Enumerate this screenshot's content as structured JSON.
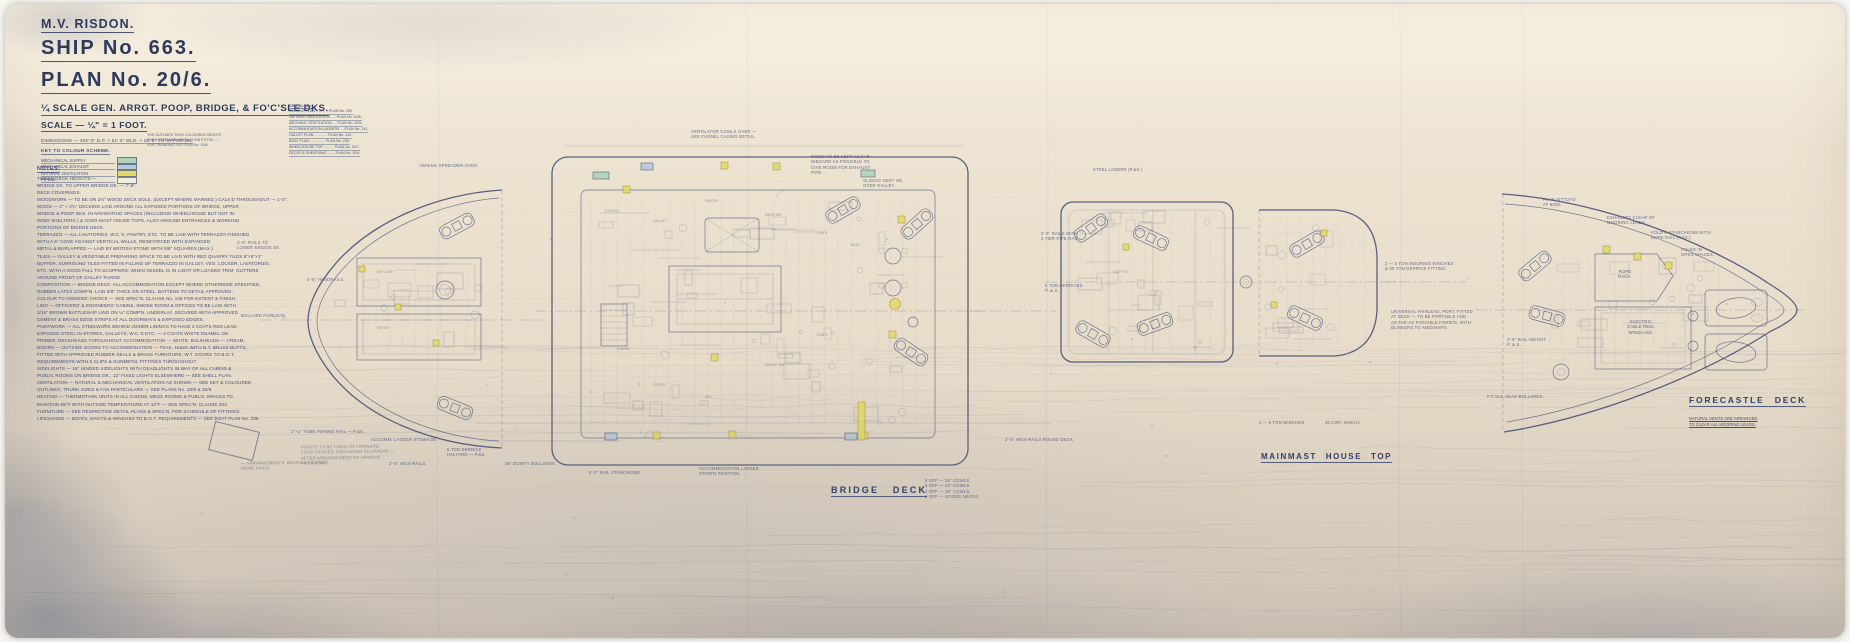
{
  "meta": {
    "paper_color": "#ebe1cf",
    "ink_color": "#3d4b75",
    "ink_strong": "#2e3a5c",
    "pencil_color": "#686d84",
    "vent_yellow": "#e2d86a"
  },
  "title_block": {
    "vessel": "M.V. RISDON.",
    "ship_no": "SHIP No. 663.",
    "plan_no": "PLAN No. 20/6.",
    "subtitle": "¼ SCALE GEN. ARRGT. POOP, BRIDGE, & FO'C'SLE DKS.",
    "scale": "SCALE — ¼\" = 1 FOOT.",
    "dimensions": "DIMENSIONS — 355'-0\" B.P. × 51'-6\" MLD. × 26'-6\" TO UPPER DK.",
    "key_heading": "KEY TO COLOUR SCHEME.",
    "key_items": [
      {
        "label": "MECHANICAL SUPPLY",
        "color": "#b2d0ba"
      },
      {
        "label": "MECHANICAL EXHAUST",
        "color": "#bcc9d7"
      },
      {
        "label": "NATURAL VENTILATION",
        "color": "#e4da6c"
      },
      {
        "label": "PIPING",
        "color": "#f2ede1"
      }
    ],
    "key_note": "THE OUTLINES THUS COLOURED DENOTE\nTHE SYSTEM OF VENTILATION FITTED —\nFOR TRUNKING SEE PLAN No. 20/8."
  },
  "see_also": {
    "heading": "SEE ALSO:—",
    "items": [
      "RIGGING PLAN ............ PLAN No. 250.",
      "NATURAL VENTILATION ..... PLAN No. 20/8.",
      "MECHAN'L VENTILATION .... PLAN No. 20/9.",
      "ACCOMMODATION LADDERS ... PLAN No. 241.",
      "GALLEY PLAN ............. PLAN No. 243.",
      "BOAT PLAN ............... PLAN No. 235.",
      "WHEELHOUSE TOP .......... PLAN No. 20/7.",
      "DECKS & SHEATHING ....... PLAN No. 20/4."
    ]
  },
  "notes": {
    "heading": "NOTES.",
    "lines": [
      "TWEEN DECK HEIGHTS:—",
      "   BRIDGE DK. TO UPPER BRIDGE DK. — 7'-6\".",
      "DECK COVERINGS.",
      "WOODWORK — TO BE ON 2½\" WOOD DECK SOLE. (EXCEPT WHERE MARKED.)      CALK'D THROUGHOUT — 1'-0\".",
      "WOOD — 2\" × 2½\" DECKING LAID AROUND ALL EXPOSED PORTIONS OF BRIDGE, UPPER",
      "   BRIDGE & POOP DKS. IN NAVIGATING SPACES (INCLUDING WHEELHOUSE BUT NOT IN",
      "   WING SHELTERS.) & OVER MAST HOUSE TOPS, ALSO AROUND ENTRANCES & WORKING",
      "   PORTIONS OF BRIDGE DECK.",
      "TERRAZZO — ALL LAVATORIES, W.C.'S, PANTRY, ETC. TO BE LAID WITH TERRAZZO FINISHED",
      "   WITH A 6\" COVE AGAINST VERTICAL WALLS, REINFORCED WITH EXPANDED",
      "   METAL & BURLAPPED — LAID BY BRITISH STONE WITH 5/8\" SQUARES (MAX.)",
      "TILES — GALLEY & VEGETABLE PREPARING SPACE TO BE LAID WITH RED QUARRY TILES 6\"×6\"×1\"",
      "   BUFFER, SURROUND TILES FITTED IN FILLING OF TERRAZZO IN GALLEY, VEG. LOCKER, LAVATORIES,",
      "   ETC. WITH A GOOD FALL TO SCUPPERS; WHEN VESSEL IS IN LIGHT OR LOADED TRIM, GUTTERS",
      "   AROUND FRONT OF GALLEY RANGE.",
      "COMPOSITION — BRIDGE DECK: ALL ACCOMMODATION EXCEPT WHERE OTHERWISE SPECIFIED,",
      "   RUBBER LATEX COMP'N. LAID 5/8\" THICK ON STEEL, BATTENS TO DETAIL APPROVED,",
      "   COLOUR TO OWNERS' CHOICE — SEE SPEC'N. CLAUSE No. 148 FOR EXTENT & FINISH.",
      "LINO — OFFICERS' & ENGINEERS' CABINS, SMOKE ROOM & OFFICES TO BE LAID WITH",
      "   3/16\" BROWN BATTLESHIP LINO ON ¼\" COMP'N. UNDERLAY, SECURED WITH APPROVED",
      "   CEMENT & BRASS EDGE STRIPS AT ALL DOORWAYS & EXPOSED EDGES.",
      "PAINTWORK — ALL STEELWORK BEHIND JOINER LININGS TO HAVE 2 COATS RED LEAD;",
      "   EXPOSED STEEL IN STORES, GALLEYS, W.C.'S ETC. — 2 COATS WHITE ENAMEL ON",
      "   PRIMER; DECKHEADS THROUGHOUT ACCOMMODATION — WHITE; BULKHEADS — CREAM.",
      "DOORS — OUTSIDE DOORS TO ACCOMMODATION — TEAK, HUNG WITH N.T. BRASS BUTTS,",
      "   FITTED WITH APPROVED RUBBER SEALS & BRASS FURNITURE; W.T. DOORS TO B.O.T.",
      "   REQUIREMENTS WITH 6 CLIPS & GUNMETAL FITTINGS THROUGHOUT.",
      "SIDELIGHTS — 16\" HINGED SIDELIGHTS WITH DEADLIGHTS IN WAY OF ALL CABINS &",
      "   PUBLIC ROOMS ON BRIDGE DK.; 12\" FIXED LIGHTS ELSEWHERE — SEE SHELL PLAN.",
      "VENTILATION — NATURAL & MECHANICAL VENTILATION AS SHOWN — SEE KEY & COLOURED",
      "   OUTLINES; TRUNK SIZES & FAN PARTICULARS — SEE PLANS No. 20/8 & 20/9.",
      "HEATING — THERMOTANK UNITS IN ALL CABINS, MESS ROOMS & PUBLIC SPACES TO",
      "   MAINTAIN 65°F WITH OUTSIDE TEMPERATURE AT 10°F — SEE SPEC'N. CLAUSE 203.",
      "FURNITURE — SEE RESPECTIVE DETAIL PLANS & SPEC'N. FOR SCHEDULE OF FITTINGS.",
      "LIFESAVING — BOATS, DAVITS & WINCHES TO B.O.T. REQUIREMENTS — SEE BOAT PLAN No. 235."
    ]
  },
  "plans": {
    "bridge": {
      "label": "BRIDGE DECK"
    },
    "mainmast": {
      "label": "MAINMAST HOUSE TOP"
    },
    "forecastle": {
      "label": "FORECASTLE DECK",
      "note": "NATURAL VENTS ARE ARRANGED\nTO CLEAR ALL MOORING LEADS."
    }
  },
  "annotations": [
    {
      "x": 232,
      "y": 236,
      "t": "2'-6\" RAILS TO\nLOWER BRIDGE DK."
    },
    {
      "x": 236,
      "y": 309,
      "t": "BOLLARD FAIRLEAD."
    },
    {
      "x": 302,
      "y": 273,
      "t": "2'-6\" HANDRAILS."
    },
    {
      "x": 414,
      "y": 159,
      "t": "AWNING SPREADER OVER."
    },
    {
      "x": 286,
      "y": 425,
      "t": "1\"×1\" TUBE AWNING RAIL — P.&S."
    },
    {
      "x": 366,
      "y": 433,
      "t": "ACCOMM. LADDER STOWAGE."
    },
    {
      "x": 442,
      "y": 443,
      "t": "5 TON DERRICK\nHALYARD — P.&S."
    },
    {
      "x": 384,
      "y": 457,
      "t": "2'-6\" HIGH RAILS."
    },
    {
      "x": 500,
      "y": 457,
      "t": "36\" DOWTY BOLLARDS."
    },
    {
      "x": 686,
      "y": 125,
      "t": "VENTILATOR COWLS OVER —\nSEE FUNNEL CASING DETAIL."
    },
    {
      "x": 806,
      "y": 150,
      "t": "ROOM TO BE KEPT AS FAR\nINBOARD AS POSSIBLE TO\nGIVE ROOM FOR EXHAUST\nPIPE."
    },
    {
      "x": 858,
      "y": 174,
      "t": "SLIDING VENT HD.\nOVER GALLEY."
    },
    {
      "x": 694,
      "y": 462,
      "t": "ACCOMMODATION LADDER\nSTOW'D POSITION."
    },
    {
      "x": 920,
      "y": 474,
      "t": "8 OFF — 36\" COWLS.\n6 OFF — 24\" COWLS.\n4 OFF — 18\" COWLS.\n2 OFF — GOOSE NECKS."
    },
    {
      "x": 584,
      "y": 466,
      "t": "5'-0\" RAIL STANCHIONS."
    },
    {
      "x": 1000,
      "y": 433,
      "t": "2'-6\" HIGH RAILS ROUND DECK."
    },
    {
      "x": 1088,
      "y": 163,
      "t": "STEEL LADDER (P.&S.)"
    },
    {
      "x": 1036,
      "y": 227,
      "t": "2'-6\" RAILS WITH\n3 TIER PIPE RAIL."
    },
    {
      "x": 1380,
      "y": 257,
      "t": "2 — 5 TON MOORING WINCHES\n& 30 TON DERRICK FITTING."
    },
    {
      "x": 1386,
      "y": 305,
      "t": "UNIVERSAL FAIRLEAD, PORT, FITTED\nAT DECK — TO BE PORTABLE AND\nAS FAR AS POSSIBLE FORW'D, WITH\nBLINKERS TO AMIDSHIPS."
    },
    {
      "x": 1040,
      "y": 279,
      "t": "5 TON DERRICKS\nP. & S."
    },
    {
      "x": 1254,
      "y": 416,
      "t": "2 — 5 TON WINCHES."
    },
    {
      "x": 1320,
      "y": 416,
      "t": "30 CWT. WINCH."
    },
    {
      "x": 1602,
      "y": 211,
      "t": "EXHAUSTS CLEAR OF\nMOORING LEADS."
    },
    {
      "x": 1646,
      "y": 226,
      "t": "FOLD'G STANCHIONS WITH\nROPE RAIL (P.&S.)"
    },
    {
      "x": 1676,
      "y": 243,
      "t": "POLES IN\nOPEN SPACES."
    },
    {
      "x": 1538,
      "y": 193,
      "t": "PLAN ATT'CH'D\nAT BOW."
    },
    {
      "x": 1502,
      "y": 333,
      "t": "2'-6\" RAIL HEIGHT\nP. & S."
    },
    {
      "x": 1482,
      "y": 390,
      "t": "F'C'SLE HEAD BOLLARDS."
    },
    {
      "x": 1620,
      "y": 265,
      "t": "ROPE\nRACK.",
      "a": "c",
      "s": 4.2,
      "o": 0.85
    },
    {
      "x": 1636,
      "y": 315,
      "t": "ELECTRIC\nCABLE REEL\nWINDLASS.",
      "a": "c",
      "s": 4.2,
      "o": 0.85
    },
    {
      "x": 372,
      "y": 266,
      "t": "SKYLIGHT",
      "s": 3.2,
      "o": 0.55
    },
    {
      "x": 372,
      "y": 322,
      "t": "HATCH",
      "s": 3.2,
      "o": 0.55
    },
    {
      "x": 1108,
      "y": 266,
      "t": "MAST HO.",
      "s": 3.2,
      "o": 0.55
    },
    {
      "x": 600,
      "y": 205,
      "t": "STORES",
      "s": 3.2,
      "o": 0.55
    },
    {
      "x": 648,
      "y": 215,
      "t": "GALLEY",
      "s": 3.2,
      "o": 0.55
    },
    {
      "x": 700,
      "y": 195,
      "t": "PANTRY",
      "s": 3.2,
      "o": 0.55
    },
    {
      "x": 760,
      "y": 209,
      "t": "MESS RM.",
      "s": 3.2,
      "o": 0.55
    },
    {
      "x": 812,
      "y": 227,
      "t": "CAB'N",
      "s": 3.2,
      "o": 0.55
    },
    {
      "x": 846,
      "y": 239,
      "t": "BATH",
      "s": 3.2,
      "o": 0.55
    },
    {
      "x": 812,
      "y": 329,
      "t": "CAB'N",
      "s": 3.2,
      "o": 0.55
    },
    {
      "x": 760,
      "y": 359,
      "t": "SMOKE RM.",
      "s": 3.2,
      "o": 0.55
    },
    {
      "x": 648,
      "y": 379,
      "t": "OFFICE",
      "s": 3.2,
      "o": 0.55
    },
    {
      "x": 700,
      "y": 391,
      "t": "W.C.",
      "s": 3.2,
      "o": 0.55
    },
    {
      "x": 612,
      "y": 343,
      "t": "STAIRS",
      "s": 3.2,
      "o": 0.55
    },
    {
      "x": 236,
      "y": 456,
      "t": "— ARRANGEMENTS, BACKS & FILLINGS WERE FIXED.",
      "p": 1
    },
    {
      "x": 296,
      "y": 440,
      "t": "POINTS TO BE FIXED TO FORWARD\nFOOD STORES, EXCLUDING SCUPPERS —\nAFTER ARRANGEMENT OF VARIOUS POSITIONS.",
      "p": 1
    }
  ]
}
